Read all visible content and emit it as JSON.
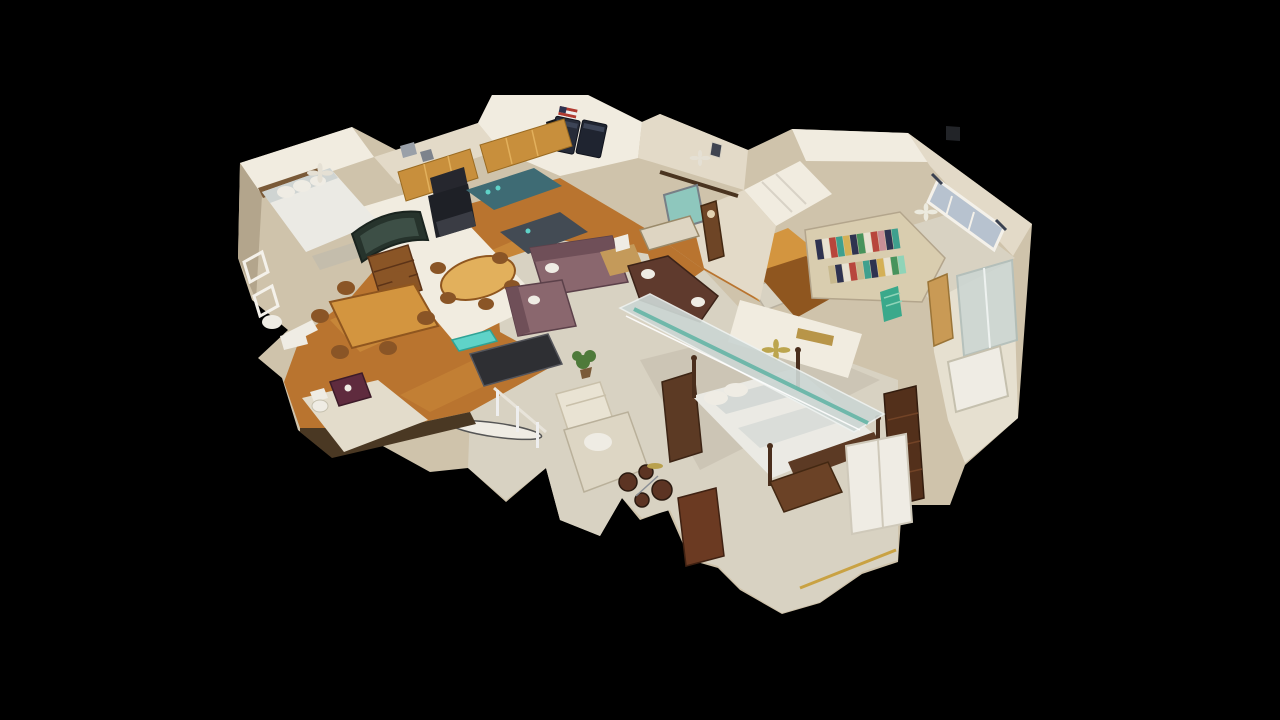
{
  "viewer": {
    "background": "#000000",
    "view_mode": "dollhouse-3d",
    "scene": "single-family-home-interior-scan"
  },
  "rooms": [
    {
      "id": "bedroom-upper-left"
    },
    {
      "id": "kitchen"
    },
    {
      "id": "laundry"
    },
    {
      "id": "sitting-room"
    },
    {
      "id": "foyer"
    },
    {
      "id": "bedroom-upper-right"
    },
    {
      "id": "walk-in-closet"
    },
    {
      "id": "bathroom-right"
    },
    {
      "id": "living-room"
    },
    {
      "id": "dining-room"
    },
    {
      "id": "primary-bedroom"
    },
    {
      "id": "den"
    },
    {
      "id": "lower-level-bathroom"
    }
  ],
  "palette": {
    "background": "#000000",
    "wallLight": "#f1ece0",
    "wall": "#e3dac8",
    "wallShade": "#cfc3ab",
    "wallDark": "#b3a58c",
    "floorWood": "#b9742f",
    "floorWoodLight": "#d3953f",
    "floorWoodDark": "#8f561f",
    "carpet": "#d8d2c2",
    "carpetShade": "#c4bdac",
    "tile": "#e6e0d0",
    "cabinetWood": "#c88f3c",
    "cabinetLight": "#e2b05c",
    "appliance": "#1e2026",
    "counterGranite": "#3e6b74",
    "sofaMauve": "#8a676e",
    "sofaMauveDark": "#6f4f58",
    "sofaLeather": "#5f3a2d",
    "woodDark": "#553522",
    "woodMid": "#8a5526",
    "bedding": "#ebeae4",
    "beddingShade": "#cfd4d2",
    "railWhite": "#efece4",
    "glassPanel": "#ccd6d3",
    "tealBright": "#5fd3c8",
    "glassTealEdge": "#5fb3a4",
    "artTeal": "#8ec7bd",
    "curtain": "#b7c2cf",
    "brassGold": "#b89548",
    "vanityPlum": "#5f2b3e",
    "plantGreen": "#4e7a3a",
    "closetNavy": "#2f3350",
    "closetRed": "#b8463c",
    "closetTeal": "#3fa08e",
    "closetYellow": "#d4b056",
    "closetGreen": "#47935c",
    "closetPink": "#c98f97",
    "closetKhaki": "#d9cdaf",
    "fanGold": "#bca54e"
  }
}
